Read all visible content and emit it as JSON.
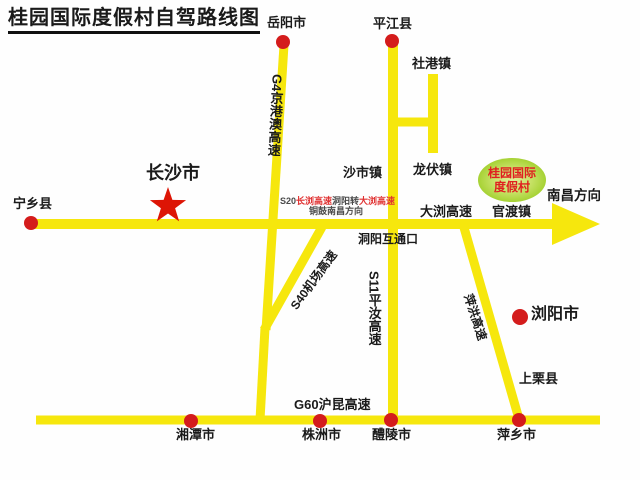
{
  "title": "桂园国际度假村自驾路线图",
  "colors": {
    "road": "#f6e70d",
    "dot": "#d41c1c",
    "star": "#dd1505",
    "ellipse_outer": "#a6d234",
    "ellipse_inner": "#e2f096",
    "resort_text": "#e02020",
    "note_red": "#e03030",
    "note_dark": "#4a4a4a",
    "text": "#1a1a1a"
  },
  "map": {
    "cities": {
      "yueyang": "岳阳市",
      "pingjiang": "平江县",
      "ningxiang": "宁乡县",
      "changsha": "长沙市",
      "liuyang": "浏阳市",
      "shangli": "上栗县",
      "xiangtan": "湘潭市",
      "zhuzhou": "株洲市",
      "liling": "醴陵市",
      "pingxiang": "萍乡市"
    },
    "towns": {
      "shegang": "社港镇",
      "shashi": "沙市镇",
      "longfu": "龙伏镇",
      "guandu": "官渡镇"
    },
    "roads": {
      "g4": "G4京港澳高速",
      "s11": "S11平汝高速",
      "s40": "S40机场高速",
      "g60": "G60沪昆高速",
      "daliu": "大浏高速",
      "pinghong": "萍洪高速"
    },
    "interchange": "洞阳互通口",
    "direction_east": "南昌方向",
    "route_note": {
      "part1": "S20",
      "part2": "长浏高速",
      "part3": "洞阳转",
      "part4": "大浏高速",
      "line2": "铜鼓南昌方向"
    },
    "resort": {
      "line1": "桂园国际",
      "line2": "度假村"
    }
  }
}
